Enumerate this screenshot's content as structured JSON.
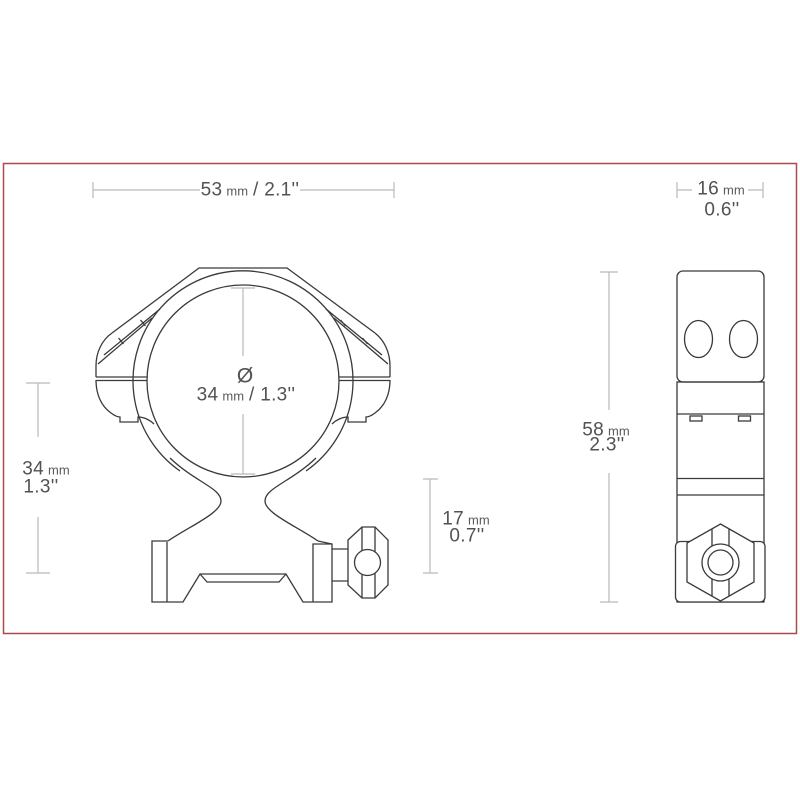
{
  "page": {
    "frame_color": "#a94b4b",
    "background": "#ffffff"
  },
  "drawing": {
    "type": "technical-drawing scope ring mount, front view and side view",
    "line_color": "#3a3a3c",
    "dim_line_color": "#b9b9b9",
    "text_color": "#515254",
    "dimensions": {
      "front_width": {
        "metric": "53",
        "unit": "mm",
        "imperial": "/ 2.1''"
      },
      "side_width": {
        "metric": "16",
        "unit": "mm",
        "imperial": "0.6''"
      },
      "ring_height": {
        "metric": "34",
        "unit": "mm",
        "imperial": "1.3''"
      },
      "tube_diameter": {
        "symbol": "Ø",
        "metric": "34",
        "unit": "mm",
        "imperial": "/ 1.3''"
      },
      "base_height": {
        "metric": "17",
        "unit": "mm",
        "imperial": "0.7''"
      },
      "side_height": {
        "metric": "58",
        "unit": "mm",
        "imperial": "2.3''"
      }
    }
  }
}
